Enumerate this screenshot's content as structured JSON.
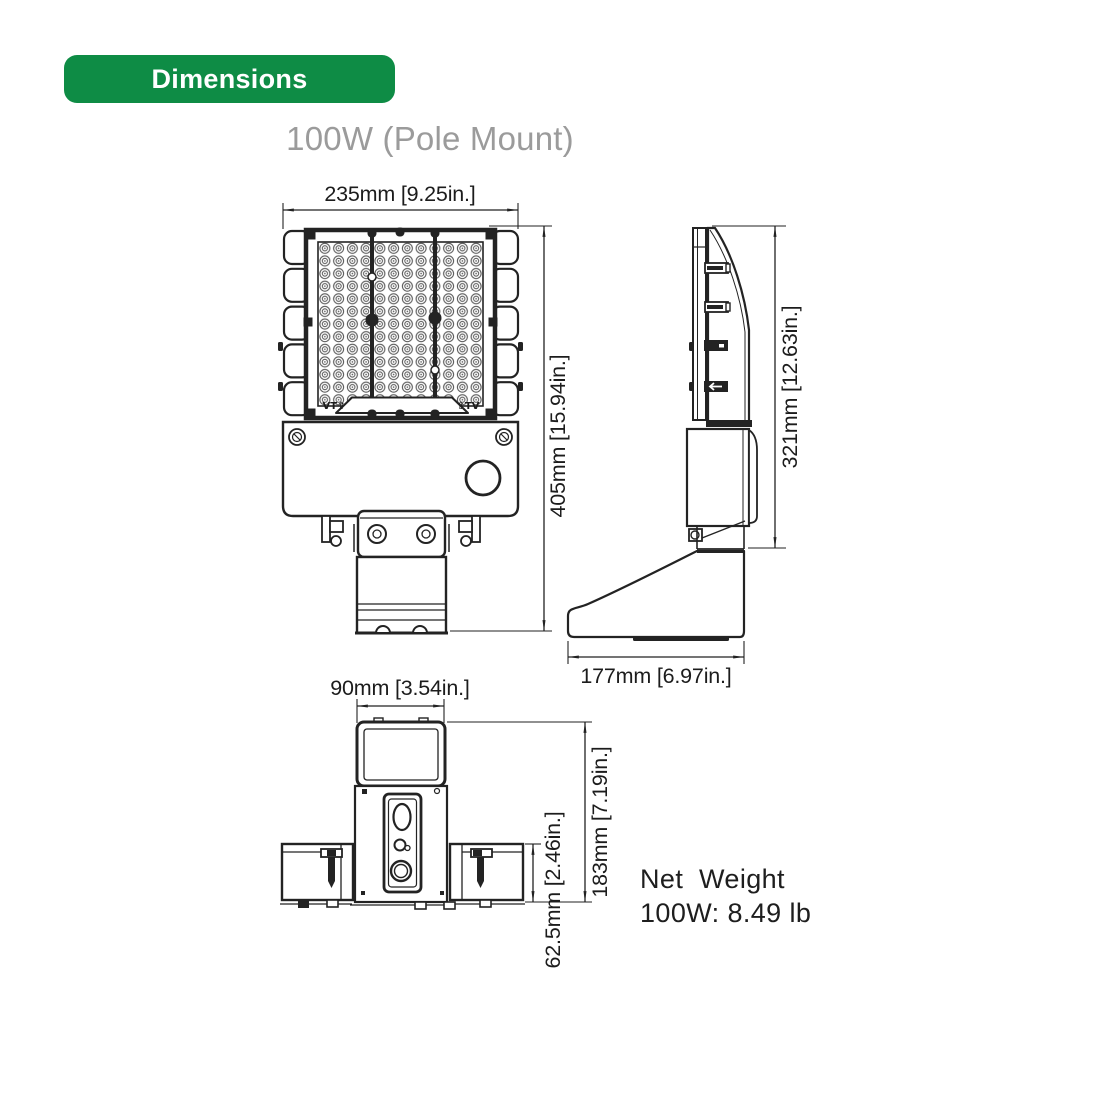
{
  "badge": {
    "label": "Dimensions"
  },
  "title": "100W (Pole Mount)",
  "views": {
    "front": {
      "width_dim": "235mm [9.25in.]",
      "height_dim": "405mm [15.94in.]",
      "lens_mark_left": "VT⇧",
      "lens_mark_right": "⇧TV"
    },
    "side": {
      "height_dim": "321mm [12.63in.]",
      "depth_dim": "177mm [6.97in.]"
    },
    "bottom": {
      "bracket_width_dim": "90mm [3.54in.]",
      "overall_depth_dim": "183mm [7.19in.]",
      "housing_depth_dim": "62.5mm [2.46in.]"
    }
  },
  "net_weight": {
    "line1": "Net  Weight",
    "line2": "100W: 8.49 lb"
  },
  "colors": {
    "accent_green": "#0E8C45",
    "badge_text": "#FFFFFF",
    "title_gray": "#9B9B9B",
    "line_dark": "#232323"
  }
}
